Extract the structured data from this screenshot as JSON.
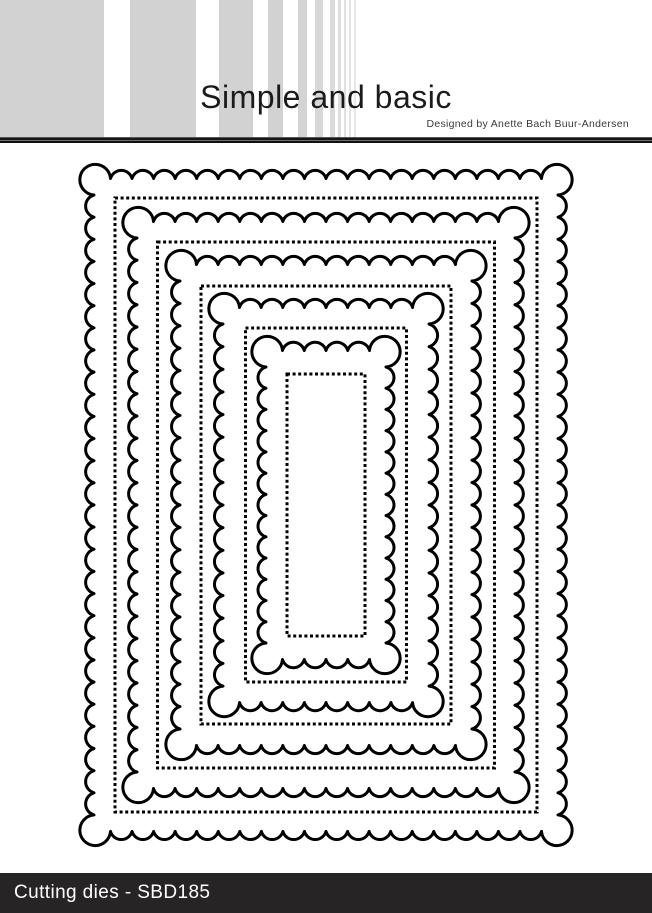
{
  "header": {
    "brand": "Simple and basic",
    "designer_credit": "Designed by Anette Bach Buur-Andersen",
    "stripes": [
      {
        "x": 0,
        "w": 104,
        "color": "#d2d2d2"
      },
      {
        "x": 130,
        "w": 66,
        "color": "#d2d2d2"
      },
      {
        "x": 219,
        "w": 34,
        "color": "#d2d2d2"
      },
      {
        "x": 268,
        "w": 15,
        "color": "#d2d2d2"
      },
      {
        "x": 298,
        "w": 9,
        "color": "#d4d4d4"
      },
      {
        "x": 315,
        "w": 8,
        "color": "#d7d7d7"
      },
      {
        "x": 330,
        "w": 5,
        "color": "#dadada"
      },
      {
        "x": 338,
        "w": 3,
        "color": "#dddddd"
      },
      {
        "x": 344,
        "w": 2,
        "color": "#e0e0e0"
      },
      {
        "x": 349,
        "w": 2,
        "color": "#e4e4e4"
      },
      {
        "x": 354,
        "w": 2,
        "color": "#e8e8e8"
      }
    ]
  },
  "dies": {
    "stroke_color": "#000000",
    "scallop_stroke_width": 3,
    "dot_stroke_width": 3,
    "dot_dash": "3 2.6",
    "scallop_wavelength": 22,
    "corner_radius": 16.5,
    "center": {
      "x": 326,
      "y": 505
    },
    "scalloped_rects": [
      {
        "w": 464,
        "h": 653
      },
      {
        "w": 378,
        "h": 567
      },
      {
        "w": 292,
        "h": 481
      },
      {
        "w": 206,
        "h": 395
      },
      {
        "w": 120,
        "h": 309
      }
    ],
    "dotted_rects": [
      {
        "w": 422,
        "h": 614
      },
      {
        "w": 337,
        "h": 526
      },
      {
        "w": 250,
        "h": 438
      },
      {
        "w": 161,
        "h": 354
      },
      {
        "w": 78,
        "h": 262
      }
    ]
  },
  "footer": {
    "label": "Cutting dies - SBD185",
    "bg_color": "#262424",
    "text_color": "#ffffff"
  }
}
